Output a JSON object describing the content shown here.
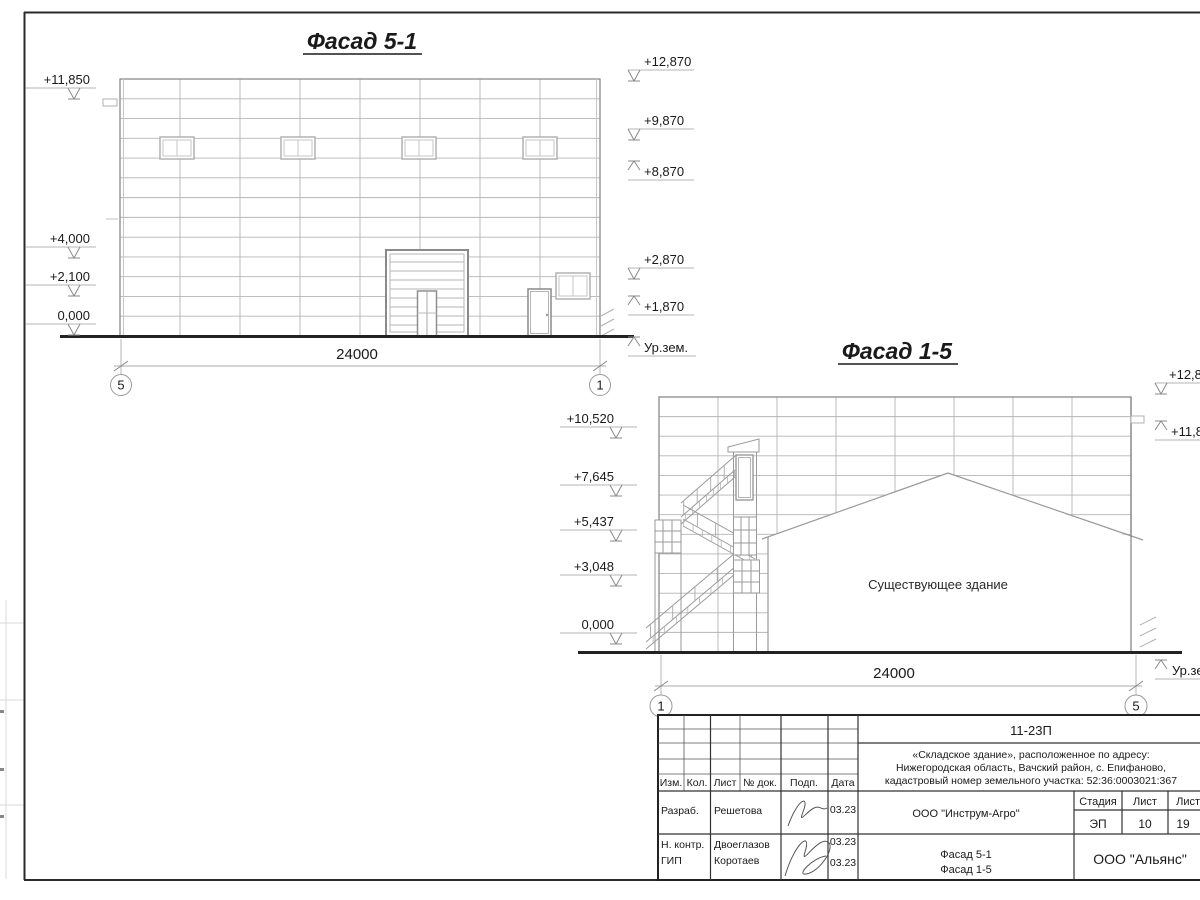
{
  "drawing": {
    "facade_51": {
      "title": "Фасад 5-1",
      "dimension_label": "24000",
      "axis_left": "5",
      "axis_right": "1",
      "markers_left": [
        "+11,850",
        "+4,000",
        "+2,100",
        "0,000"
      ],
      "markers_right": [
        "+12,870",
        "+9,870",
        "+8,870",
        "+2,870",
        "+1,870",
        "Ур.зем."
      ]
    },
    "facade_15": {
      "title": "Фасад 1-5",
      "dimension_label": "24000",
      "axis_left": "1",
      "axis_right": "5",
      "existing_building_label": "Существующее здание",
      "markers_left": [
        "+10,520",
        "+7,645",
        "+5,437",
        "+3,048",
        "0,000"
      ],
      "markers_right": [
        "+12,870",
        "+11,850",
        "Ур.зем."
      ]
    },
    "title_block": {
      "doc_number": "11-23П",
      "description_line1": "«Складское здание», расположенное по адресу:",
      "description_line2": "Нижегородская область, Вачский район, с. Епифаново,",
      "description_line3": "кадастровый номер земельного участка: 52:36:0003021:367",
      "client_org": "ООО \"Инструм-Агро\"",
      "design_org": "ООО \"Альянс\"",
      "sheet_name_line1": "Фасад 5-1",
      "sheet_name_line2": "Фасад 1-5",
      "col_izm": "Изм.",
      "col_kol": "Кол.",
      "col_list": "Лист",
      "col_doc": "№ док.",
      "col_podp": "Подп.",
      "col_data": "Дата",
      "stage_label": "Стадия",
      "sheet_label": "Лист",
      "sheets_label": "Листов",
      "stage_value": "ЭП",
      "sheet_value": "10",
      "sheets_value": "19",
      "role_1": "Разраб.",
      "name_1": "Решетова",
      "date_1": "03.23",
      "role_2": "Н. контр.",
      "name_2": "Двоеглазов",
      "date_2": "03.23",
      "role_3": "ГИП",
      "name_3": "Коротаев",
      "date_3": "03.23"
    }
  }
}
